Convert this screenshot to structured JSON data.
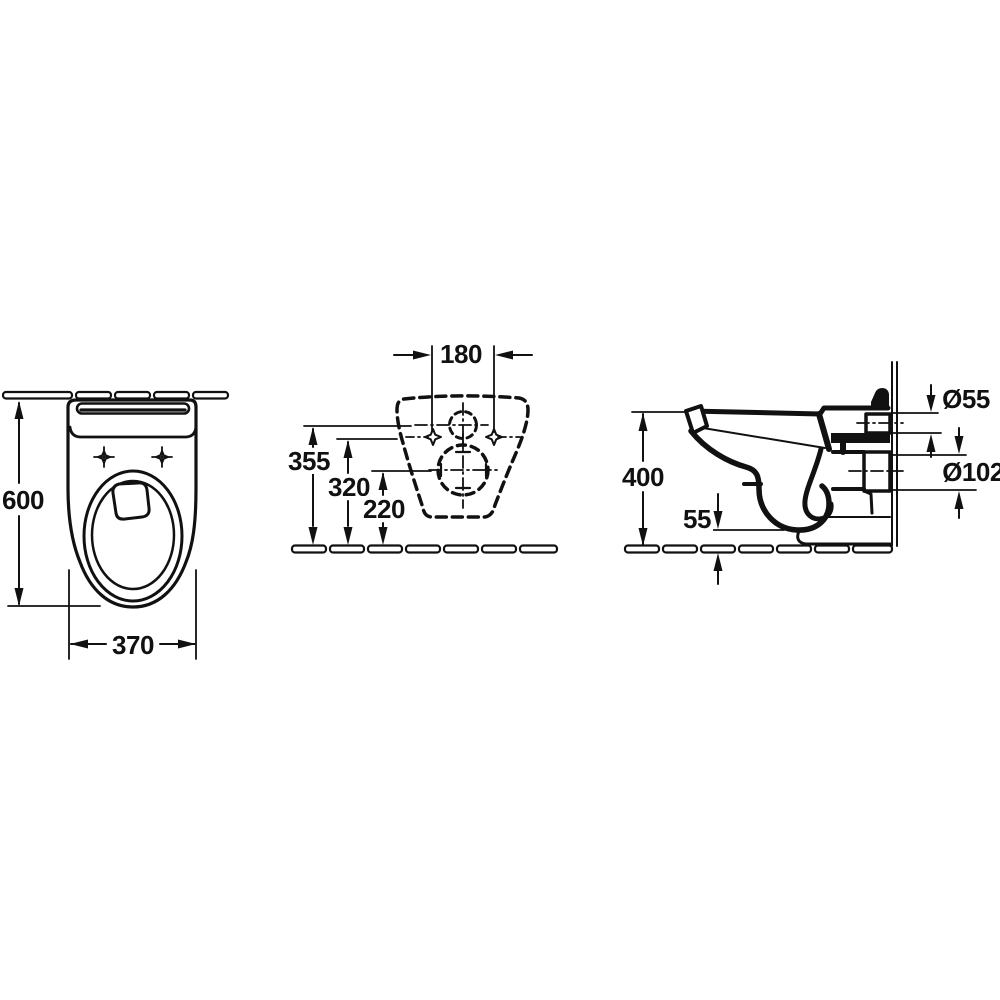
{
  "drawing": {
    "kind": "sanitary-ware installation dimension drawing",
    "colors": {
      "line": "#111111",
      "background": "#ffffff"
    },
    "views": {
      "top": {
        "depth": "600",
        "width": "370"
      },
      "rear": {
        "fixing_hole_spacing": "180",
        "inlet_center_height": "355",
        "fixing_hole_height": "320",
        "outlet_center_height": "220"
      },
      "side": {
        "rim_height": "400",
        "floor_clearance": "55",
        "inlet_diameter": "Ø55",
        "outlet_diameter": "Ø102"
      }
    }
  }
}
